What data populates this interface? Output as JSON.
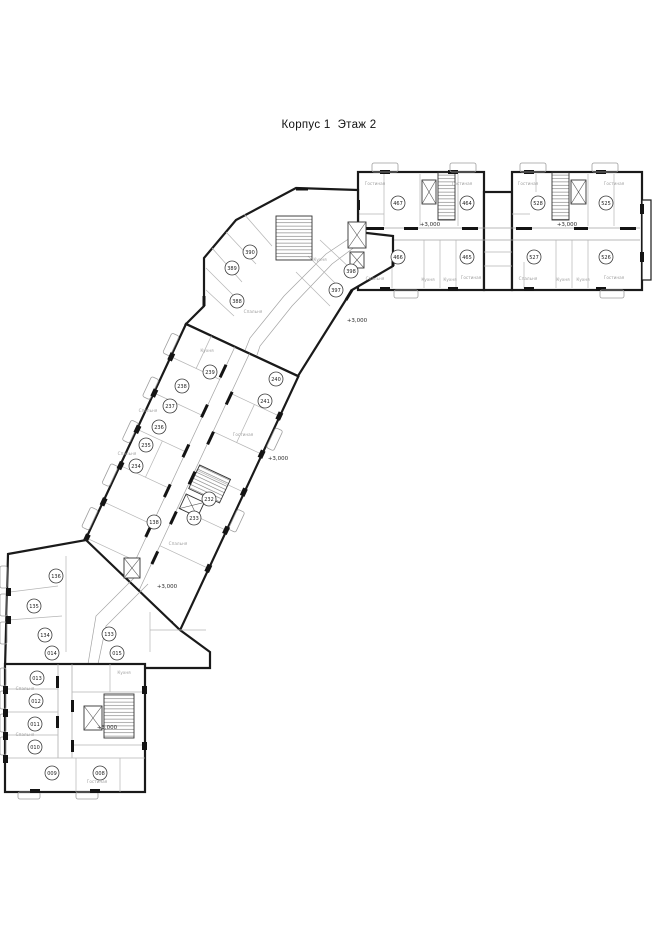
{
  "title": "Корпус 1  Этаж 2",
  "plan": {
    "elevation_label": "+3,000",
    "elevation_marks": [
      {
        "x": 430,
        "y": 226
      },
      {
        "x": 567,
        "y": 226
      },
      {
        "x": 357,
        "y": 322
      },
      {
        "x": 278,
        "y": 460
      },
      {
        "x": 167,
        "y": 588
      },
      {
        "x": 107,
        "y": 729
      }
    ],
    "units": [
      {
        "id": "467",
        "x": 398,
        "y": 203
      },
      {
        "id": "464",
        "x": 467,
        "y": 203
      },
      {
        "id": "528",
        "x": 538,
        "y": 203
      },
      {
        "id": "525",
        "x": 606,
        "y": 203
      },
      {
        "id": "466",
        "x": 398,
        "y": 257
      },
      {
        "id": "465",
        "x": 467,
        "y": 257
      },
      {
        "id": "527",
        "x": 534,
        "y": 257
      },
      {
        "id": "526",
        "x": 606,
        "y": 257
      },
      {
        "id": "390",
        "x": 250,
        "y": 252
      },
      {
        "id": "389",
        "x": 232,
        "y": 268
      },
      {
        "id": "388",
        "x": 237,
        "y": 301
      },
      {
        "id": "398",
        "x": 351,
        "y": 271
      },
      {
        "id": "397",
        "x": 336,
        "y": 290
      },
      {
        "id": "239",
        "x": 210,
        "y": 372
      },
      {
        "id": "240",
        "x": 276,
        "y": 379
      },
      {
        "id": "238",
        "x": 182,
        "y": 386
      },
      {
        "id": "241",
        "x": 265,
        "y": 401
      },
      {
        "id": "237",
        "x": 170,
        "y": 406
      },
      {
        "id": "236",
        "x": 159,
        "y": 427
      },
      {
        "id": "235",
        "x": 146,
        "y": 445
      },
      {
        "id": "234",
        "x": 136,
        "y": 466
      },
      {
        "id": "232",
        "x": 209,
        "y": 499
      },
      {
        "id": "233",
        "x": 194,
        "y": 518
      },
      {
        "id": "138",
        "x": 154,
        "y": 522
      },
      {
        "id": "136",
        "x": 56,
        "y": 576
      },
      {
        "id": "135",
        "x": 34,
        "y": 606
      },
      {
        "id": "134",
        "x": 45,
        "y": 635
      },
      {
        "id": "133",
        "x": 109,
        "y": 634
      },
      {
        "id": "014",
        "x": 52,
        "y": 653
      },
      {
        "id": "015",
        "x": 117,
        "y": 653
      },
      {
        "id": "013",
        "x": 37,
        "y": 678
      },
      {
        "id": "012",
        "x": 36,
        "y": 701
      },
      {
        "id": "011",
        "x": 35,
        "y": 724
      },
      {
        "id": "010",
        "x": 35,
        "y": 747
      },
      {
        "id": "009",
        "x": 52,
        "y": 773
      },
      {
        "id": "008",
        "x": 100,
        "y": 773
      }
    ],
    "room_labels": [
      {
        "text": "Гостиная",
        "x": 375,
        "y": 185
      },
      {
        "text": "Гостиная",
        "x": 462,
        "y": 185
      },
      {
        "text": "Спальня",
        "x": 375,
        "y": 280
      },
      {
        "text": "Кухня",
        "x": 428,
        "y": 281
      },
      {
        "text": "Кухня",
        "x": 450,
        "y": 281
      },
      {
        "text": "Гостиная",
        "x": 471,
        "y": 279
      },
      {
        "text": "Гостиная",
        "x": 528,
        "y": 185
      },
      {
        "text": "Гостиная",
        "x": 614,
        "y": 185
      },
      {
        "text": "Спальня",
        "x": 528,
        "y": 280
      },
      {
        "text": "Кухня",
        "x": 563,
        "y": 281
      },
      {
        "text": "Кухня",
        "x": 583,
        "y": 281
      },
      {
        "text": "Гостиная",
        "x": 614,
        "y": 279
      },
      {
        "text": "Спальня",
        "x": 253,
        "y": 313
      },
      {
        "text": "Кухня",
        "x": 320,
        "y": 261
      },
      {
        "text": "Кухня",
        "x": 207,
        "y": 352
      },
      {
        "text": "Спальня",
        "x": 148,
        "y": 412
      },
      {
        "text": "Гостиная",
        "x": 243,
        "y": 436
      },
      {
        "text": "Спальня",
        "x": 127,
        "y": 455
      },
      {
        "text": "Спальня",
        "x": 178,
        "y": 545
      },
      {
        "text": "Кухня",
        "x": 124,
        "y": 674
      },
      {
        "text": "Спальня",
        "x": 25,
        "y": 690
      },
      {
        "text": "Спальня",
        "x": 25,
        "y": 736
      },
      {
        "text": "Гостиная",
        "x": 97,
        "y": 783
      }
    ],
    "colors": {
      "wall": "#1a1a1a",
      "partition": "#b5b5b5",
      "label": "#a0a0a0",
      "text": "#1d1d1d",
      "background": "#ffffff"
    }
  }
}
